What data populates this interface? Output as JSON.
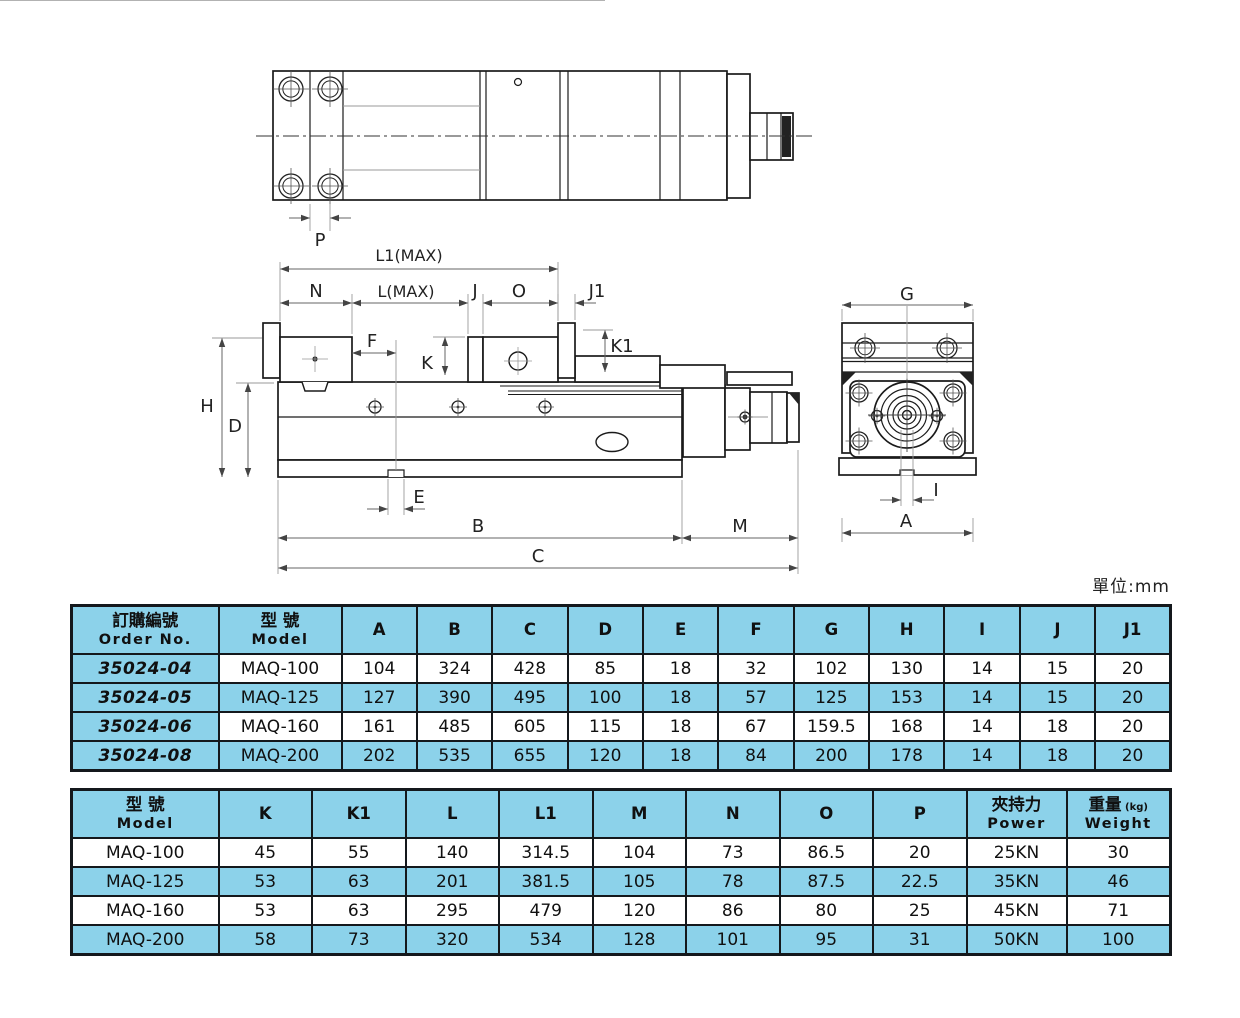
{
  "unit_label": "單位:mm",
  "colors": {
    "cell_blue": "#8CD2EA",
    "table_border": "#14181c",
    "drawing_line": "#1a1a1a",
    "dim_line": "#666666"
  },
  "drawing": {
    "labels": {
      "p": "P",
      "l1": "L1(MAX)",
      "n": "N",
      "l": "L(MAX)",
      "j": "J",
      "o": "O",
      "j1": "J1",
      "f": "F",
      "k": "K",
      "k1": "K1",
      "h": "H",
      "d": "D",
      "e": "E",
      "b": "B",
      "m": "M",
      "c": "C",
      "g": "G",
      "i": "I",
      "a": "A"
    }
  },
  "table1": {
    "headers": [
      {
        "l1": "訂購編號",
        "l2": "Order No."
      },
      {
        "l1": "型 號",
        "l2": "Model"
      },
      {
        "l1": "A"
      },
      {
        "l1": "B"
      },
      {
        "l1": "C"
      },
      {
        "l1": "D"
      },
      {
        "l1": "E"
      },
      {
        "l1": "F"
      },
      {
        "l1": "G"
      },
      {
        "l1": "H"
      },
      {
        "l1": "I"
      },
      {
        "l1": "J"
      },
      {
        "l1": "J1"
      }
    ],
    "rows": [
      {
        "cells": [
          "35024-04",
          "MAQ-100",
          "104",
          "324",
          "428",
          "85",
          "18",
          "32",
          "102",
          "130",
          "14",
          "15",
          "20"
        ]
      },
      {
        "cells": [
          "35024-05",
          "MAQ-125",
          "127",
          "390",
          "495",
          "100",
          "18",
          "57",
          "125",
          "153",
          "14",
          "15",
          "20"
        ]
      },
      {
        "cells": [
          "35024-06",
          "MAQ-160",
          "161",
          "485",
          "605",
          "115",
          "18",
          "67",
          "159.5",
          "168",
          "14",
          "18",
          "20"
        ]
      },
      {
        "cells": [
          "35024-08",
          "MAQ-200",
          "202",
          "535",
          "655",
          "120",
          "18",
          "84",
          "200",
          "178",
          "14",
          "18",
          "20"
        ]
      }
    ]
  },
  "table2": {
    "headers": [
      {
        "l1": "型 號",
        "l2": "Model"
      },
      {
        "l1": "K"
      },
      {
        "l1": "K1"
      },
      {
        "l1": "L"
      },
      {
        "l1": "L1"
      },
      {
        "l1": "M"
      },
      {
        "l1": "N"
      },
      {
        "l1": "O"
      },
      {
        "l1": "P"
      },
      {
        "l1": "夾持力",
        "l2": "Power"
      },
      {
        "l1": "重量",
        "small": "(kg)",
        "l2": "Weight"
      }
    ],
    "rows": [
      {
        "cells": [
          "MAQ-100",
          "45",
          "55",
          "140",
          "314.5",
          "104",
          "73",
          "86.5",
          "20",
          "25KN",
          "30"
        ]
      },
      {
        "cells": [
          "MAQ-125",
          "53",
          "63",
          "201",
          "381.5",
          "105",
          "78",
          "87.5",
          "22.5",
          "35KN",
          "46"
        ]
      },
      {
        "cells": [
          "MAQ-160",
          "53",
          "63",
          "295",
          "479",
          "120",
          "86",
          "80",
          "25",
          "45KN",
          "71"
        ]
      },
      {
        "cells": [
          "MAQ-200",
          "58",
          "73",
          "320",
          "534",
          "128",
          "101",
          "95",
          "31",
          "50KN",
          "100"
        ]
      }
    ]
  }
}
